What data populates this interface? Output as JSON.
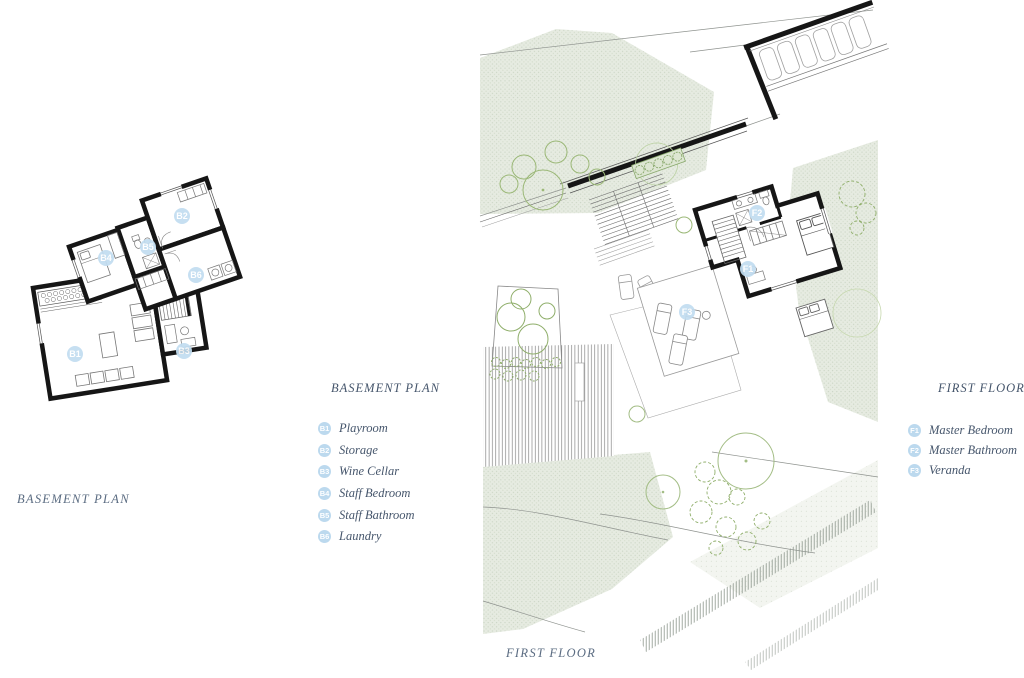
{
  "basement_legend": {
    "title": "BASEMENT PLAN",
    "items": [
      {
        "code": "B1",
        "label": "Playroom"
      },
      {
        "code": "B2",
        "label": "Storage"
      },
      {
        "code": "B3",
        "label": "Wine Cellar"
      },
      {
        "code": "B4",
        "label": "Staff Bedroom"
      },
      {
        "code": "B5",
        "label": "Staff Bathroom"
      },
      {
        "code": "B6",
        "label": "Laundry"
      }
    ]
  },
  "first_floor_legend": {
    "title": "FIRST FLOOR",
    "items": [
      {
        "code": "F1",
        "label": "Master Bedroom"
      },
      {
        "code": "F2",
        "label": "Master Bathroom"
      },
      {
        "code": "F3",
        "label": "Veranda"
      }
    ]
  },
  "captions": {
    "basement": "BASEMENT PLAN",
    "first_floor": "FIRST FLOOR"
  },
  "plan_labels": {
    "basement": [
      {
        "code": "B1"
      },
      {
        "code": "B2"
      },
      {
        "code": "B3"
      },
      {
        "code": "B4"
      },
      {
        "code": "B5"
      },
      {
        "code": "B6"
      }
    ],
    "first_floor": [
      {
        "code": "F1"
      },
      {
        "code": "F2"
      },
      {
        "code": "F3"
      }
    ]
  },
  "colors": {
    "sage_fill": "#e6ebe1",
    "wall_black": "#161616",
    "tree_green": "#9bb877",
    "label_blue": "#c2ddf1",
    "legend_text": "#46566c",
    "caption_text": "#5b6c82"
  }
}
